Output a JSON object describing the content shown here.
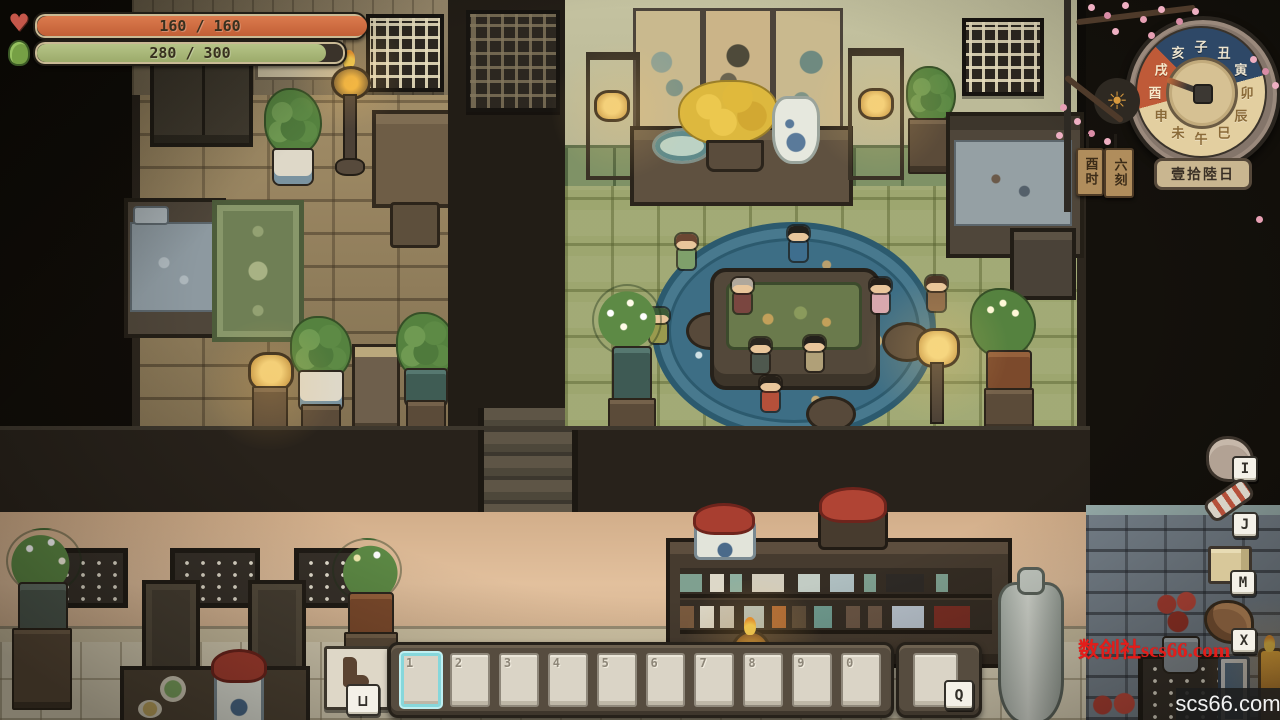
{
  "hud": {
    "health": {
      "current": 160,
      "max": 160,
      "label": "160 / 160",
      "fill_color": "#cd6a3f"
    },
    "stamina": {
      "current": 280,
      "max": 300,
      "label": "280 / 300",
      "fill_color": "#a9b87a"
    }
  },
  "clock": {
    "zodiac": [
      {
        "char": "子",
        "phase": "night"
      },
      {
        "char": "丑",
        "phase": "night"
      },
      {
        "char": "寅",
        "phase": "night"
      },
      {
        "char": "卯",
        "phase": "day"
      },
      {
        "char": "辰",
        "phase": "day"
      },
      {
        "char": "巳",
        "phase": "day"
      },
      {
        "char": "午",
        "phase": "day"
      },
      {
        "char": "未",
        "phase": "day"
      },
      {
        "char": "申",
        "phase": "day"
      },
      {
        "char": "酉",
        "phase": "sunset"
      },
      {
        "char": "戌",
        "phase": "sunset"
      },
      {
        "char": "亥",
        "phase": "night"
      }
    ],
    "hand_angle_deg": 290,
    "day_icon_glyph": "☀",
    "time_tag": "酉时",
    "quarter_tag": "六刻",
    "date_plaque": "壹拾陸日",
    "colors": {
      "night": "#2e4867",
      "day": "#e3cfa0",
      "sunset": "#bf5a38"
    }
  },
  "shortcuts": [
    {
      "key": "I",
      "icon": "pouch-bag-icon"
    },
    {
      "key": "J",
      "icon": "quest-scroll-icon"
    },
    {
      "key": "M",
      "icon": "map-book-icon"
    },
    {
      "key": "X",
      "icon": "horse-mount-icon"
    }
  ],
  "hotbar": {
    "slot_keys": [
      "1",
      "2",
      "3",
      "4",
      "5",
      "6",
      "7",
      "8",
      "9",
      "0"
    ],
    "selected_index": 0,
    "quick_use_key": "Q",
    "autorun_key_label": "⊔",
    "selected_color": "#86d7db"
  },
  "watermarks": {
    "red_text": "数创社scs66.com",
    "corner_text": "scs66.com"
  }
}
